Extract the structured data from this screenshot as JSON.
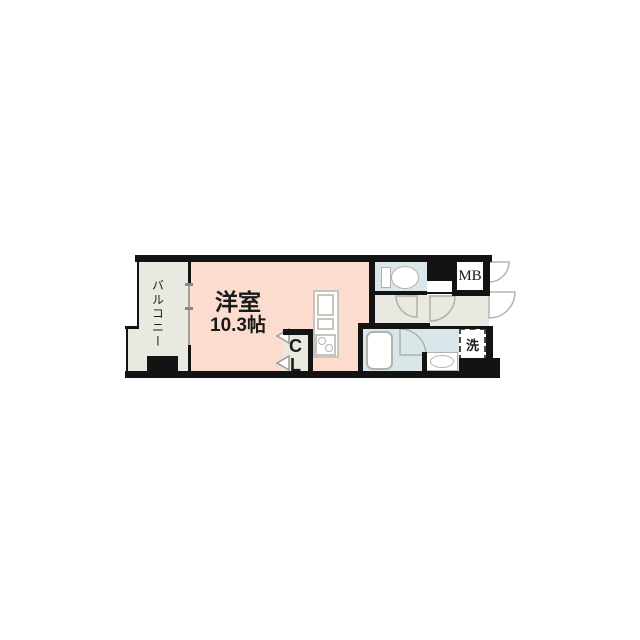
{
  "rooms": {
    "main": {
      "name": "洋室",
      "size": "10.3帖"
    },
    "balcony": {
      "name": "バルコニー"
    },
    "closet": {
      "letter_top": "C",
      "letter_bottom": "L"
    },
    "meter_box": {
      "label": "MB"
    },
    "laundry_space": {
      "label": "洗"
    }
  },
  "fixtures": [
    "toilet",
    "bathtub",
    "wash-basin",
    "kitchen-sink",
    "stove",
    "washing-machine-space",
    "pipe-shaft"
  ],
  "colors": {
    "room_pink": "#fbdccf",
    "floor_gray": "#e9e9e1",
    "wet_blue": "#d9e6ea",
    "wall_black": "#131313",
    "outline_gray": "#b3b3ab",
    "white": "#ffffff"
  }
}
